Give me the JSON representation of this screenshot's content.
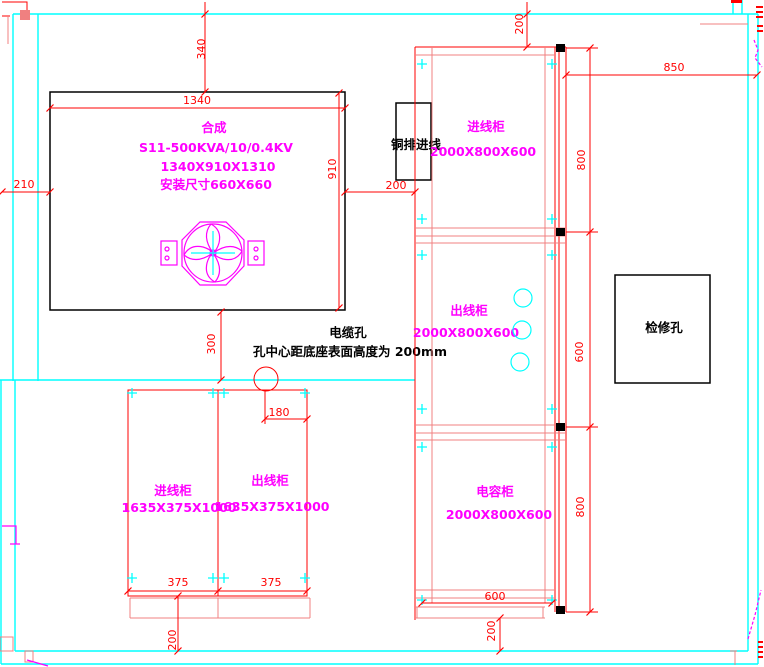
{
  "transformer": {
    "name": "合成",
    "model": "S11-500KVA/10/0.4KV",
    "size": "1340X910X1310",
    "mount": "安装尺寸660X660"
  },
  "busbar_inlet": {
    "label": "铜排进线"
  },
  "inspection_hole": {
    "label": "检修孔"
  },
  "cable_hole": {
    "title": "电缆孔",
    "note": "孔中心距底座表面高度为 200mm"
  },
  "right_cabinets": {
    "incoming": {
      "name": "进线柜",
      "size": "2000X800X600"
    },
    "outgoing": {
      "name": "出线柜",
      "size": "2000X800X600"
    },
    "capacitor": {
      "name": "电容柜",
      "size": "2000X800X600"
    }
  },
  "bottom_cabinets": {
    "incoming": {
      "name": "进线柜",
      "size": "1635X375X1000"
    },
    "outgoing": {
      "name": "出线柜",
      "size": "1635X375X1000"
    }
  },
  "dimensions": {
    "d340": "340",
    "d1340": "1340",
    "d910": "910",
    "d210": "210",
    "d200_gap": "200",
    "d300": "300",
    "d180": "180",
    "d375_a": "375",
    "d375_b": "375",
    "d200_bl": "200",
    "d600_bottom": "600",
    "d200_br": "200",
    "d200_top": "200",
    "d850": "850",
    "d800_top": "800",
    "d600_mid": "600",
    "d800_bottom": "800"
  },
  "colors": {
    "wall": "#00FFFF",
    "dimension": "#FF0000",
    "cabinet_line": "#F08080",
    "equipment_label": "#FF00FF",
    "outline": "#000000",
    "background": "#FFFFFF"
  }
}
